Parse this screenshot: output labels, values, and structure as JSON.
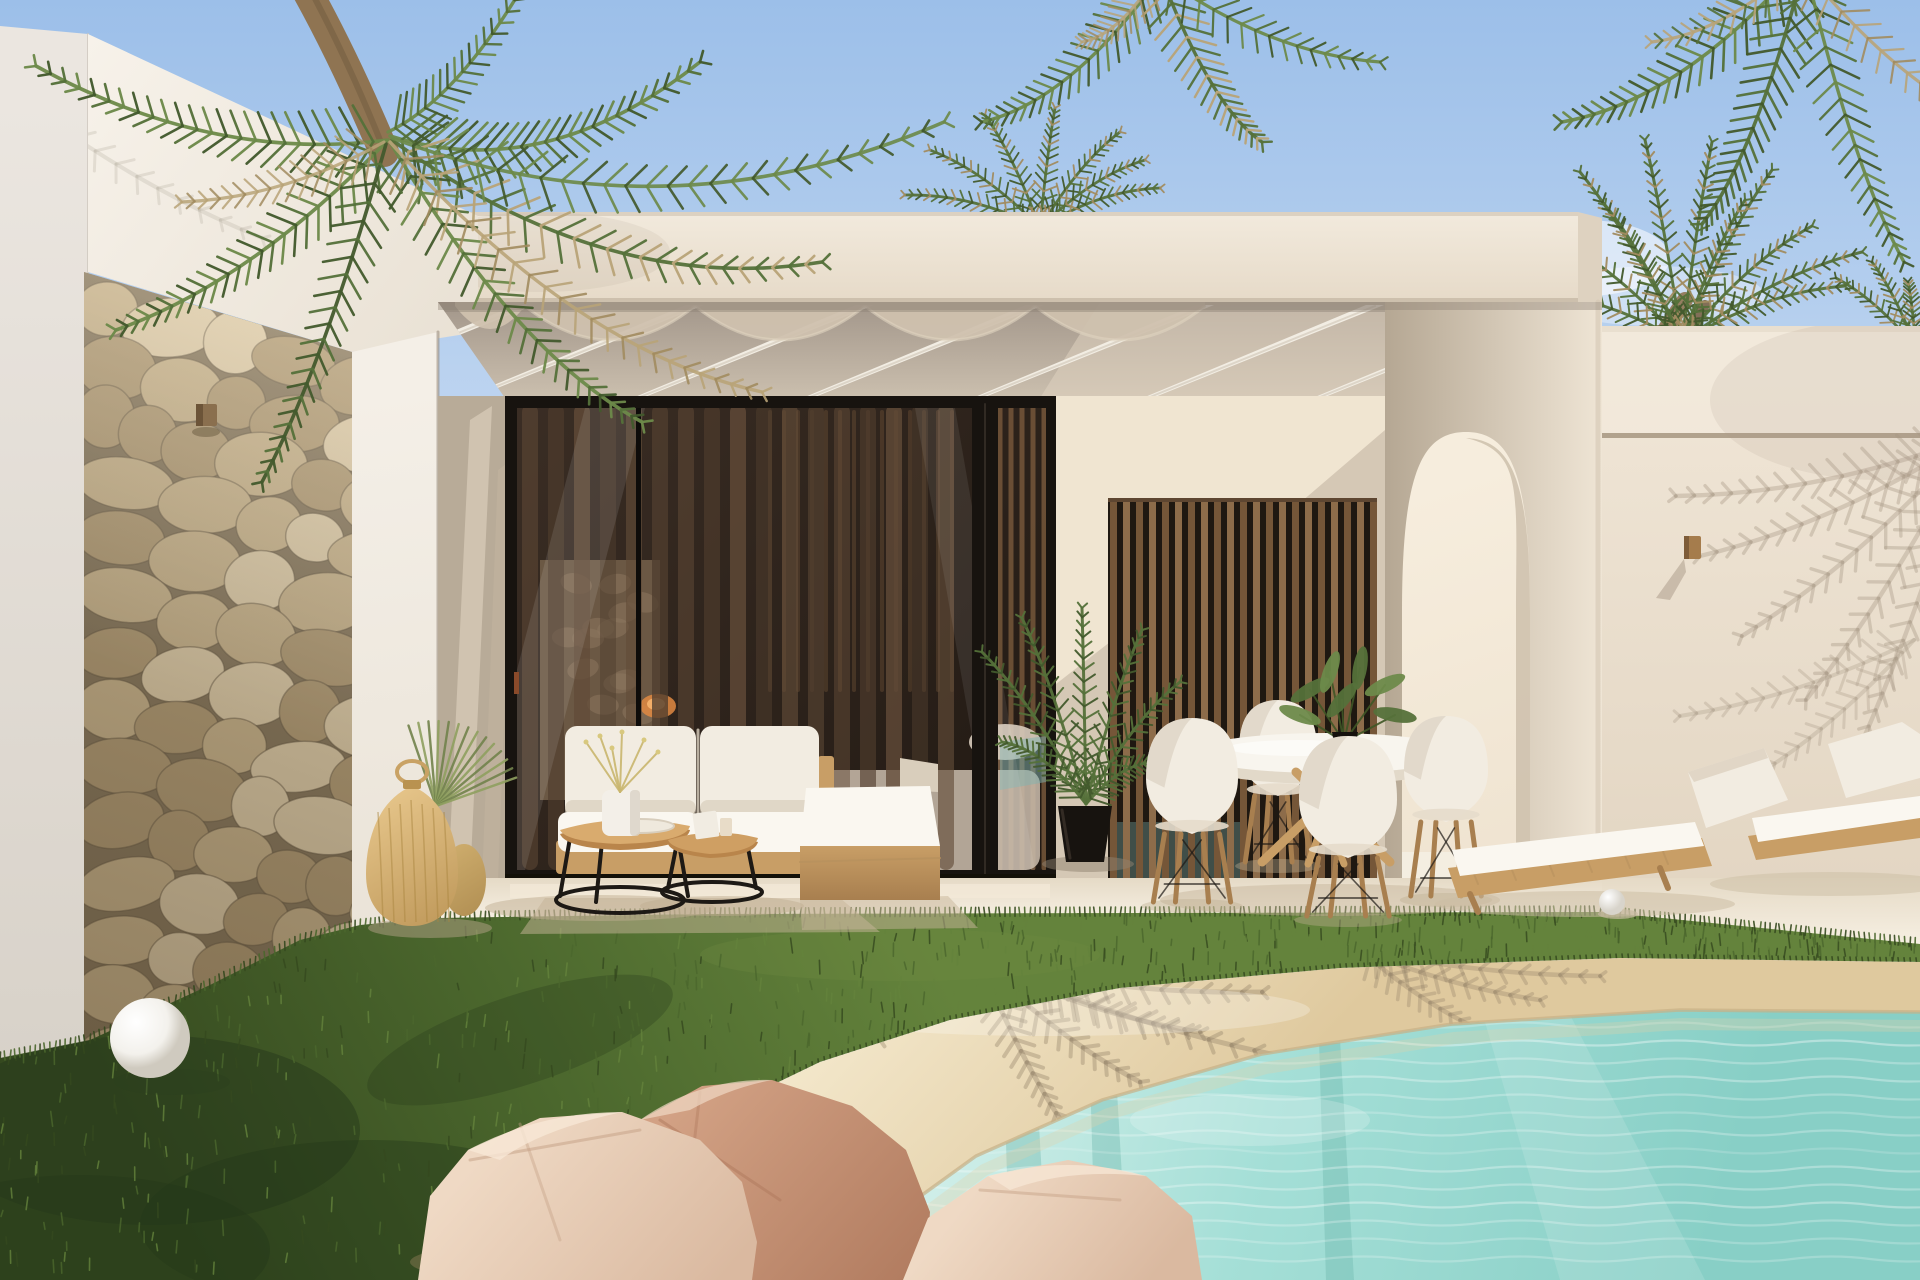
{
  "scene": {
    "title": "Modern white villa with pergola patio and beach-entry pool, sunny day render",
    "objects": [
      "sky",
      "hanging palm fronds",
      "palm crowns behind roof",
      "white fascia parapet",
      "stone feature wall",
      "stone wall spotlight",
      "pergola beams with scalloped canopy",
      "black framed glass sliding doors",
      "sheer curtains",
      "interior fireplace glow",
      "wood slat screen",
      "arched opening",
      "right wall with groove line",
      "wall lamp",
      "outdoor sofa with white cushions",
      "wooden daybed",
      "nesting coffee tables",
      "vase with dried flowers",
      "potted palm",
      "round dining table",
      "white shell chairs",
      "table plant",
      "two sun loungers",
      "rattan lanterns",
      "ornamental grass",
      "white sphere lamp",
      "white pebble",
      "green lawn",
      "sandy pool deck with palm shadows",
      "pink boulders",
      "turquoise pool water with palm reflections"
    ],
    "palette": {
      "sky_top": "#9cbfe9",
      "sky_low": "#d6e4f5",
      "cloud": "#ffffff",
      "fascia": "#f2eadd",
      "fascia_dark": "#e6dac8",
      "fascia_edge": "#cdc0ad",
      "wing": "#f7f2ea",
      "wing_dark": "#e9e1d4",
      "side_wall": "#ebe6e0",
      "side_wall_dark": "#d8d2c9",
      "recess_wall": "#d5c8b5",
      "recess_shade": "#b8ab98",
      "recess_light": "#f3e8d4",
      "ceiling_front": "#a2968a",
      "ceiling_back": "#cbbfae",
      "beam": "#f2ede3",
      "beam_shade": "#d7cfc1",
      "canopy": "#cfc1ae",
      "stone_bg": "#8a7a5f",
      "stone_a": "#dbc9a6",
      "stone_b": "#c7b28b",
      "stone_c": "#b29c76",
      "stone_dark": "#6e5f49",
      "glass_frame": "#17130f",
      "glass_hi": "#3a2d24",
      "glass_lo": "#211913",
      "curtain_a": "#503d2e",
      "curtain_b": "#634c38",
      "wood_slat": "#8d6c4a",
      "wood_slat_dark": "#755638",
      "int_wood": "#7a5a3c",
      "fire_glow": "#e08a42",
      "fire_core": "#f4b06a",
      "arch_shade": "#b5a793",
      "arch_light": "#efe5d5",
      "arch_inner": "#f6eddd",
      "arch_inner_sh": "#cbbda9",
      "rwall": "#f1e7d8",
      "rwall_low": "#e3d6c3",
      "groove": "#b1a28d",
      "lamp_wood": "#a57c4c",
      "floor": "#f7f0e3",
      "floor_dark": "#e5dac6",
      "threshold": "#131008",
      "grass_hi": "#64833c",
      "grass_mid": "#4b672d",
      "grass_dark": "#35491f",
      "grass_deep": "#24361a",
      "sand_hi": "#f5eacf",
      "sand_mid": "#ebd8ae",
      "sand_low": "#dfc99e",
      "sand_shadow": "#8d7c63",
      "water_edge": "#d8f1ec",
      "water_mid": "#a5dfd7",
      "water_deep": "#88cfc6",
      "water_dark": "#6cb5ac",
      "waterline": "#c8b086",
      "rock_hi": "#efd9c4",
      "rock_a": "#dab9a0",
      "rock_b": "#d2a184",
      "rock_dark": "#b07a5e",
      "cushion": "#f2ece1",
      "cushion_hi": "#faf7f0",
      "cushion_sh": "#d9cebc",
      "wood_l": "#c89e66",
      "wood_d": "#a87f4f",
      "black": "#1d1915",
      "palm_1": "#6d8a4a",
      "palm_2": "#55713a",
      "palm_3": "#435a2d",
      "palm_dry": "#b9a478",
      "palm_dry2": "#a28c60",
      "trunk": "#8f7452",
      "shadow_warm": "#9b8b74",
      "shadow_wall": "#a79885",
      "white": "#fbfaf6",
      "sphere_sh": "#2c3f1d",
      "pool_reflect": "#7fb4b0",
      "handle": "#8a4a2a"
    }
  }
}
